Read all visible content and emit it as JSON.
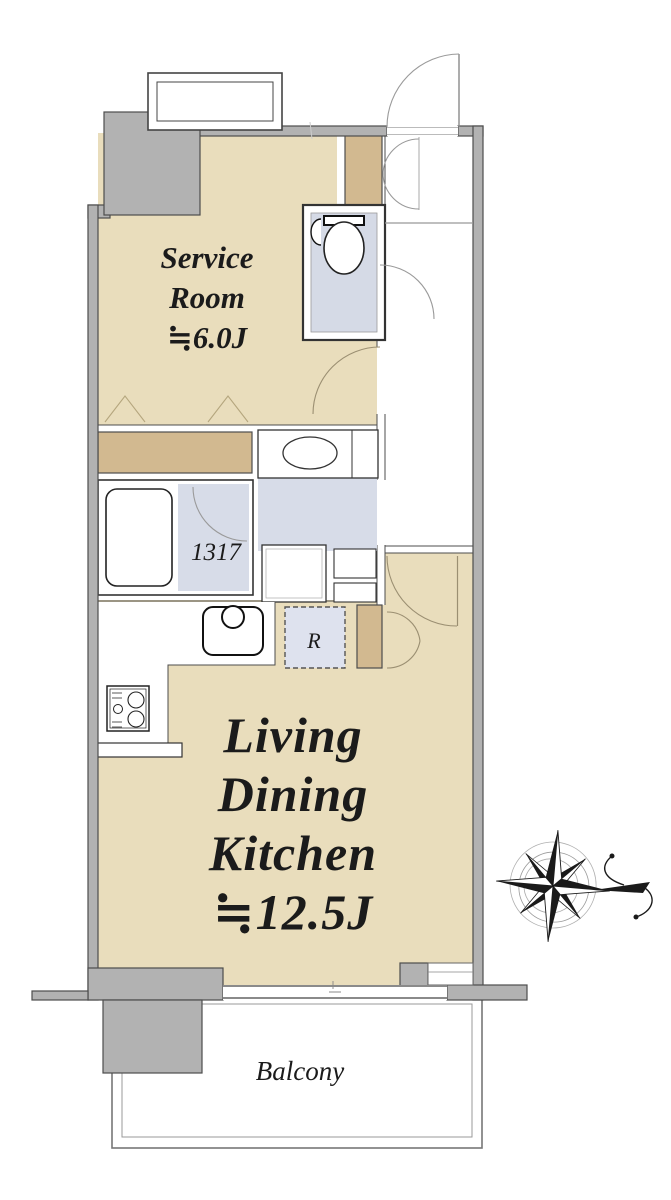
{
  "plan": {
    "type": "apartment-floor-plan",
    "rooms": {
      "service_room": {
        "lines": [
          "Service",
          "Room",
          "≒6.0J"
        ]
      },
      "ldk": {
        "lines": [
          "Living",
          "Dining",
          "Kitchen",
          "≒12.5J"
        ]
      },
      "balcony": {
        "label": "Balcony"
      },
      "bathroom": {
        "size_label": "1317"
      },
      "refrigerator": {
        "label": "R"
      }
    },
    "colors": {
      "floor": "#e9ddbc",
      "closet": "#d2b990",
      "wet_floor": "#d7dce8",
      "toilet_floor": "#d5dae6",
      "fridge_space": "#dee2ee",
      "wall": "#b2b2b2",
      "white": "#ffffff",
      "compass": "#1a1a1a"
    }
  }
}
